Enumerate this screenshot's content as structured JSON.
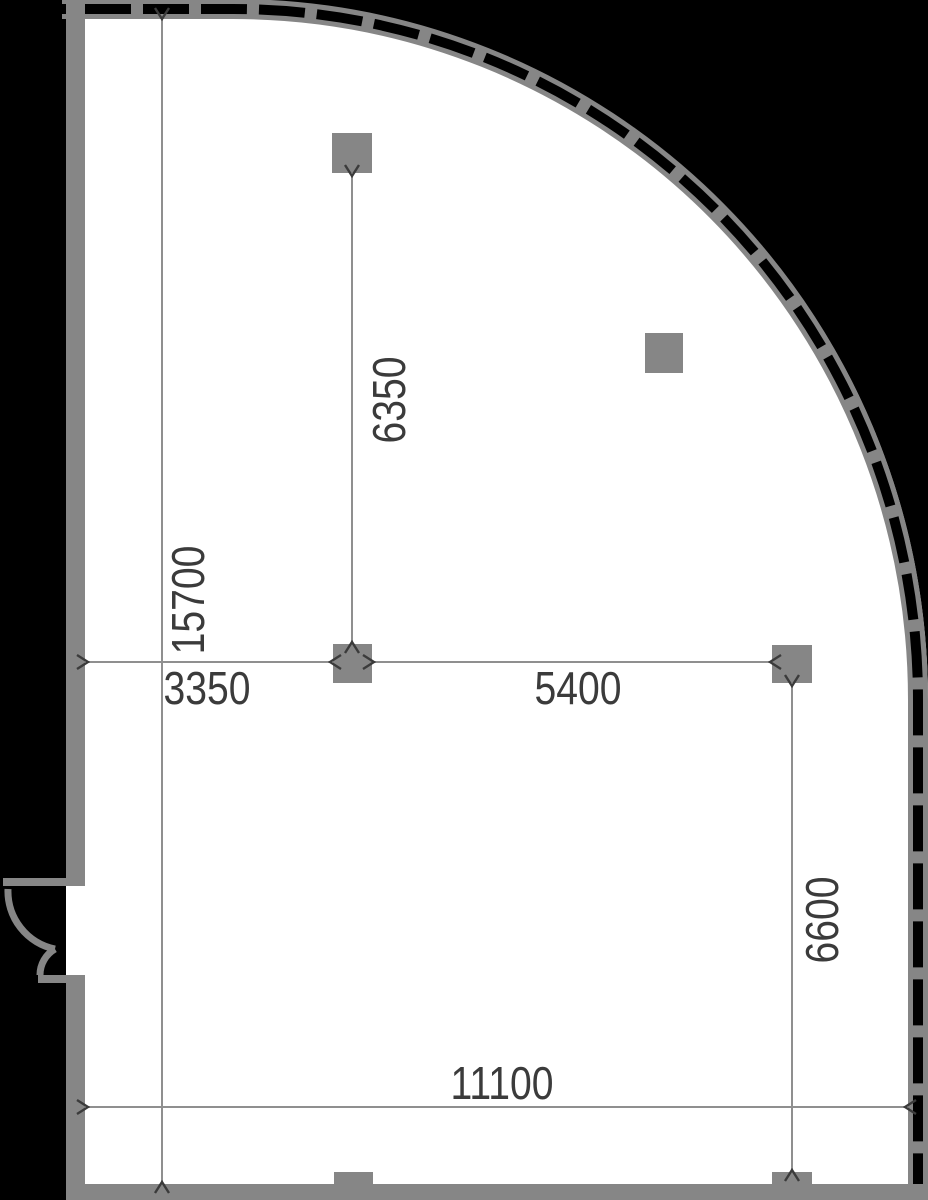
{
  "plan": {
    "type": "architectural-floor-plan",
    "features": {
      "curved_curtain_wall": true,
      "columns": 4,
      "wall_pilasters": 2,
      "door": "double-leaf swing door on left wall"
    }
  },
  "dimensions": {
    "left_overall": {
      "value": "15700",
      "orientation": "vertical"
    },
    "top_column_span": {
      "value": "6350",
      "orientation": "vertical"
    },
    "wall_to_column": {
      "value": "3350",
      "orientation": "horizontal"
    },
    "column_to_column": {
      "value": "5400",
      "orientation": "horizontal"
    },
    "column_to_bottom": {
      "value": "6600",
      "orientation": "vertical"
    },
    "bottom_overall": {
      "value": "11100",
      "orientation": "horizontal"
    }
  },
  "colors": {
    "background": "#000000",
    "room": "#ffffff",
    "wall": "#868686",
    "dim-line": "#8f8f8f",
    "annotation": "#3b3b3b"
  }
}
